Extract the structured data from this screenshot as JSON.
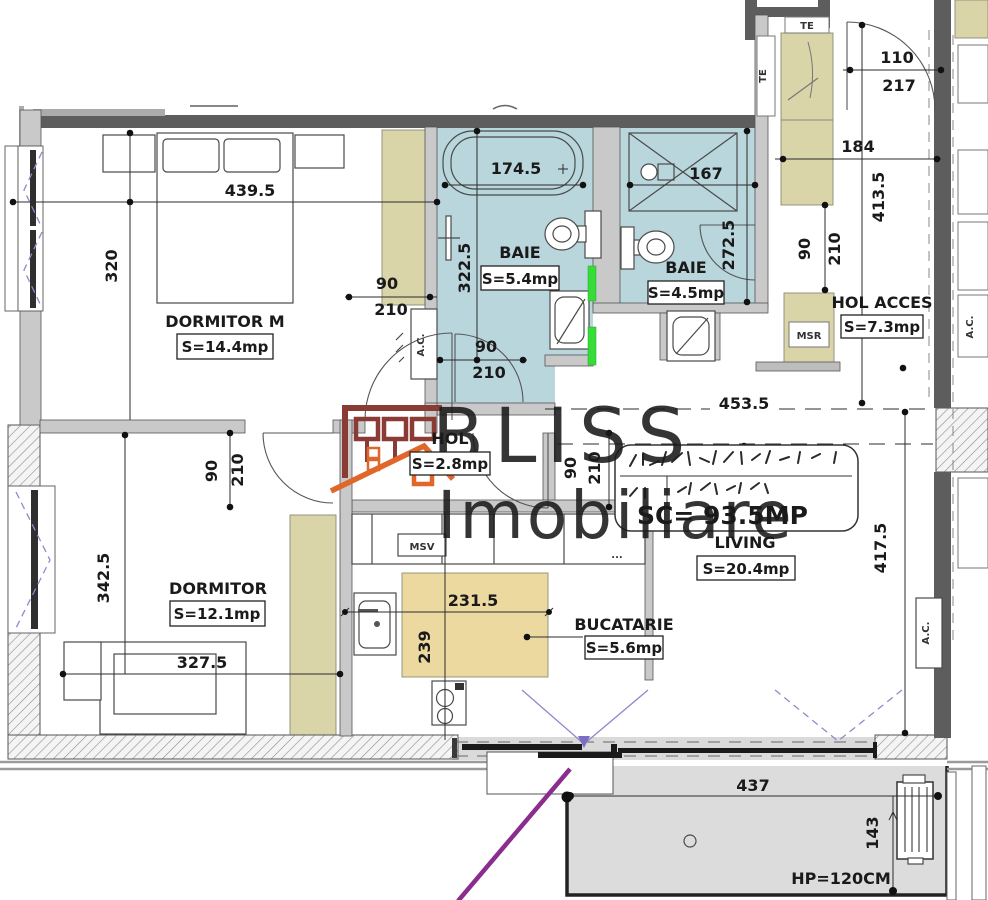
{
  "watermark": {
    "brand": "BLISS",
    "brand_sub": "Imobiliare"
  },
  "total_area": "SC= 93.5MP",
  "rooms": {
    "dormitor_m": {
      "name": "DORMITOR M",
      "area": "S=14.4mp"
    },
    "baie_1": {
      "name": "BAIE",
      "area": "S=5.4mp"
    },
    "baie_2": {
      "name": "BAIE",
      "area": "S=4.5mp"
    },
    "hol_acces": {
      "name": "HOL ACCES",
      "area": "S=7.3mp"
    },
    "hol": {
      "name": "HOL",
      "area": "S=2.8mp"
    },
    "dormitor": {
      "name": "DORMITOR",
      "area": "S=12.1mp"
    },
    "living": {
      "name": "LIVING",
      "area": "S=20.4mp"
    },
    "bucatarie": {
      "name": "BUCATARIE",
      "area": "S=5.6mp"
    }
  },
  "dimensions": {
    "dorm_m_width": "439.5",
    "dorm_m_depth": "320",
    "bathtub_width": "174.5",
    "baie_1_depth": "322.5",
    "shower_width": "167",
    "baie_2_depth": "272.5",
    "entry_door_width": "110",
    "entry_door_height": "217",
    "hol_acces_width": "184",
    "hol_acces_depth": "413.5",
    "living_width": "453.5",
    "living_depth": "417.5",
    "door_width": "90",
    "door_height": "210",
    "dormitor_depth": "342.5",
    "dormitor_width": "327.5",
    "kitchen_width": "231.5",
    "kitchen_depth": "239",
    "balcony_width": "437",
    "balcony_depth": "143",
    "parapet_height": "HP=120CM"
  },
  "labels": {
    "ac_unit": "A.C.",
    "msv": "MSV",
    "msr": "MSR",
    "te": "TE",
    "ellipsis": "..."
  },
  "colors": {
    "bathroom_fill": "#b9d6dc",
    "furniture_fill": "#d9d5a8",
    "island_fill": "#ecd9a0",
    "balcony_fill": "#dcdcdc",
    "wall_dark": "#5d5d5d",
    "wall_light": "#c9c9c9",
    "total_red": "#d93a34",
    "logo_maroon": "#8a3b34",
    "logo_orange": "#e0662a",
    "radiator_green": "#37db3a",
    "opening_purple": "#9188cc",
    "marker_purple": "#8b2d8e"
  }
}
